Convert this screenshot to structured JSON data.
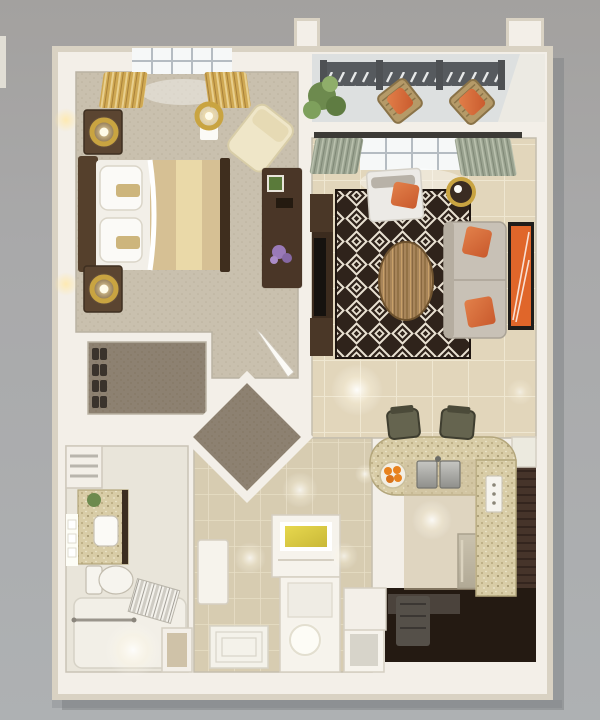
{
  "meta": {
    "label": "3D rendered top-down floor plan of a one-bedroom apartment",
    "view": "top-down-3d-render"
  },
  "colors": {
    "bg_top": "#a3a19f",
    "bg_mid": "#a9a9aa",
    "bg_bottom": "#aeb1b3",
    "shadow": "#7e8184",
    "wall_outer": "#d9d2c3",
    "wall_white": "#f3efe8",
    "wall_shade": "#c5beae",
    "bedroom_carpet": "#c9c0ae",
    "carpet_dot": "#bcb29e",
    "closet_carpet": "#8d8171",
    "closet_dot": "#82755f",
    "tile_living": "#e2d6bb",
    "tile_grout": "#efe7d1",
    "tile_entry": "#d7ccb1",
    "tile_entry_grout": "#e7dec6",
    "bathroom_floor": "#e9e5da",
    "balcony_floor": "#dde0e0",
    "railing_dark": "#565a5e",
    "rug_dark": "#2f231b",
    "rug_cream": "#e9e1d2",
    "sofa_gray": "#c8c1b6",
    "accent_orange": "#d9693a",
    "accent_orange_dark": "#c95a2d",
    "art_orange": "#e0662a",
    "gold": "#c9a441",
    "gold_light": "#ffe9ad",
    "curtain_gold": "#cfa852",
    "curtain_gold_hi": "#e8cf8e",
    "curtain_green": "#9aa390",
    "curtain_green_hi": "#b9c0ad",
    "wood_dark": "#4a3627",
    "wood_head": "#55402c",
    "wood_mid": "#a8855a",
    "duvet_tan": "#d6c094",
    "runner_cream": "#ead9a8",
    "mattress_white": "#f2efe8",
    "granite": "#d8cca6",
    "granite_dot1": "#b7a97e",
    "granite_dot2": "#efe9cf",
    "kitchen_dark": "#241a12",
    "cabinet_brown": "#46342a",
    "steel_light": "#c6c6c2",
    "steel_dark": "#8f8f8b",
    "glass_gold": "#d8c435",
    "pure_white": "#fbfaf6",
    "plant_green": "#6d8a4e",
    "plant_green_dark": "#5f7c42",
    "flower_purple": "#9a7ab8",
    "stool_olive": "#65644f",
    "window_white": "#f6f8f8",
    "mullion_gray": "#b5bcc2"
  },
  "rooms": [
    {
      "name": "Bedroom",
      "floor": "beige carpet",
      "furniture": [
        "double-bed",
        "headboard",
        "nightstand",
        "nightstand",
        "gold-table-lamp",
        "gold-table-lamp",
        "gold-floor-lamp",
        "cream-lounge-chair",
        "dark-wood-dresser",
        "purple-flowers",
        "gold-curtains",
        "paned-window",
        "door-leaf"
      ]
    },
    {
      "name": "Balcony",
      "floor": "light concrete",
      "furniture": [
        "slatted-railing",
        "wood-patio-chair-orange-cushion",
        "wood-patio-chair-orange-cushion",
        "potted-tree"
      ]
    },
    {
      "name": "Living Room",
      "floor": "large beige tile",
      "furniture": [
        "diamond-pattern-rug",
        "oval-wood-coffee-table",
        "sofa-with-orange-pillows",
        "white-daybed",
        "round-gold-side-table",
        "tv-console",
        "tv",
        "framed-orange-art",
        "green-curtains",
        "skylight-window"
      ]
    },
    {
      "name": "Kitchen",
      "floor": "dark walnut",
      "furniture": [
        "granite-breakfast-bar",
        "bar-stool",
        "bar-stool",
        "double-sink",
        "bowl-of-oranges",
        "stainless-dishwasher",
        "slatted-cabinets",
        "outlet-panel",
        "fridge-top",
        "dark-counter"
      ]
    },
    {
      "name": "Walk-in Closet",
      "floor": "taupe carpet",
      "furniture": [
        "shoe-pairs",
        "side-shelf"
      ]
    },
    {
      "name": "Vestibule",
      "floor": "taupe carpet",
      "furniture": [
        "corner-steps"
      ]
    },
    {
      "name": "Bathroom",
      "floor": "cream stone",
      "furniture": [
        "granite-vanity",
        "sink",
        "mirror-light-strip",
        "toilet",
        "bathtub",
        "striped-towel",
        "grab-bar",
        "linen-shelves",
        "green-plant",
        "shower-niche",
        "door-leaf"
      ]
    },
    {
      "name": "Entry Hall",
      "floor": "small beige tile",
      "furniture": [
        "console-table-gold-glass-top",
        "white-alcove",
        "globe-lamp",
        "ribbed-door-mat",
        "glass-front-cabinet"
      ]
    }
  ]
}
